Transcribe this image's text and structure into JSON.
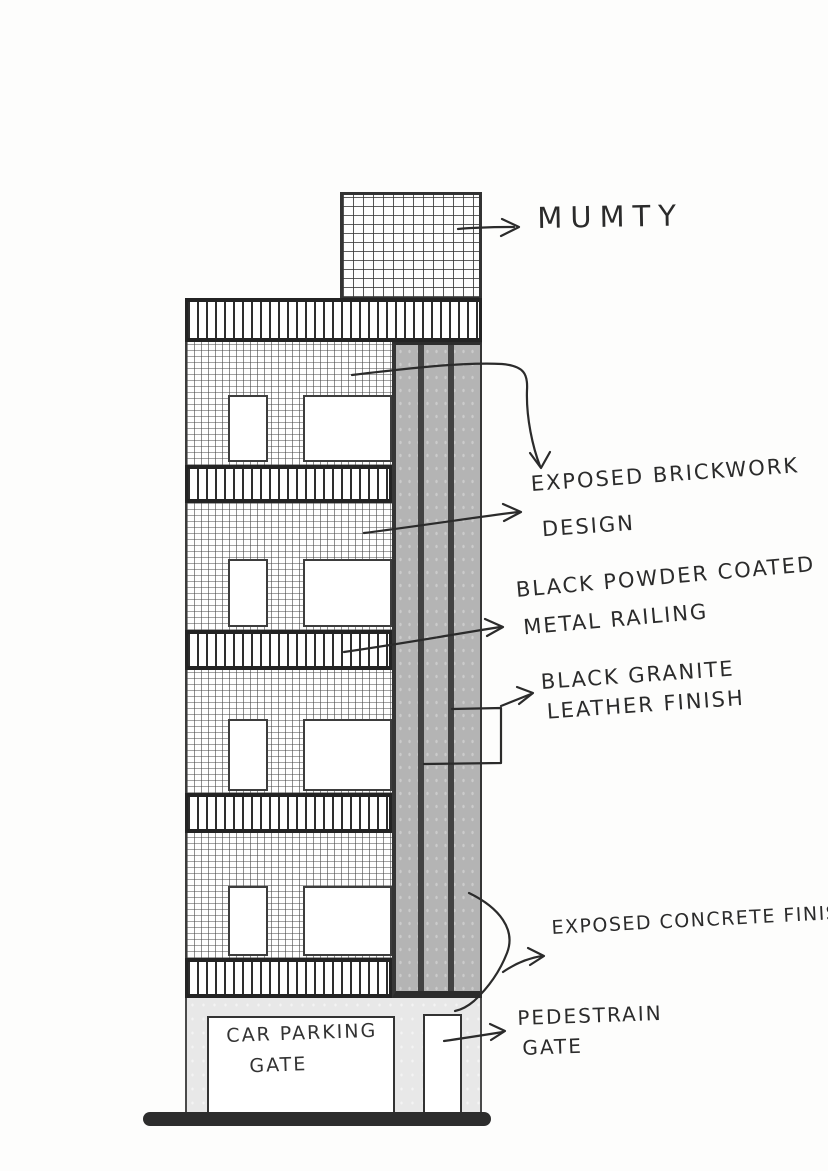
{
  "drawing": {
    "type": "hand-drawn building elevation sketch",
    "floors": 4,
    "labels": {
      "mumty": "MUMTY",
      "brickwork_1": "EXPOSED BRICKWORK",
      "brickwork_2": "DESIGN",
      "railing_1": "BLACK POWDER COATED",
      "railing_2": "METAL RAILING",
      "granite_1": "BLACK GRANITE",
      "granite_2": "LEATHER FINISH",
      "concrete": "EXPOSED CONCRETE FINISH",
      "pedestrian_1": "PEDESTRAIN",
      "pedestrian_2": "GATE",
      "car_parking_1": "CAR PARKING",
      "car_parking_2": "GATE"
    },
    "colors": {
      "ink": "#2b2b2b",
      "column_gray": "#b4b4b4",
      "granite_stripe": "#424242",
      "ground_wall": "#e8e8e8",
      "paper": "#fdfdfc"
    }
  }
}
